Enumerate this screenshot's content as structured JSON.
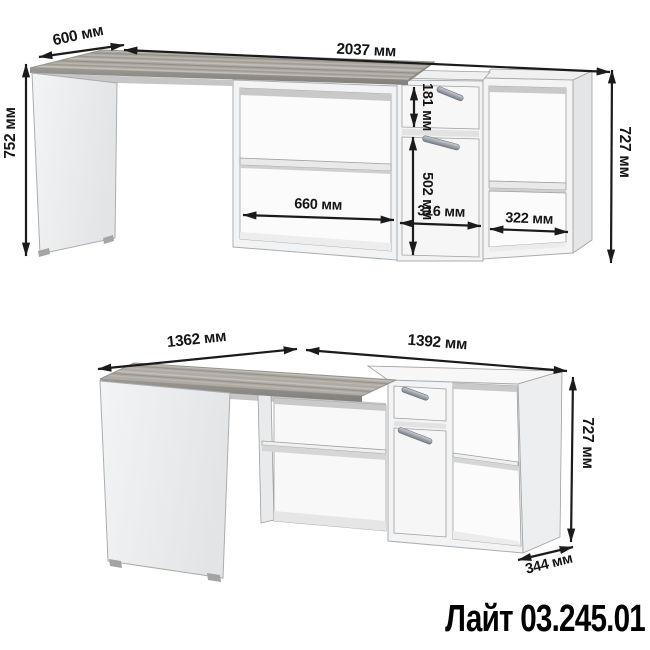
{
  "product": {
    "name": "Лайт 03.245.01"
  },
  "front_view": {
    "depth": "600 мм",
    "total_width": "2037 мм",
    "desk_height": "752 мм",
    "cabinet_height": "727 мм",
    "drawer_height": "181 мм",
    "door_height": "502 мм",
    "desk_niche_width": "660 мм",
    "drawer_section_width": "316 мм",
    "shelf_section_width": "322 мм"
  },
  "perspective_view": {
    "desk_length": "1362 мм",
    "cabinet_length": "1392 мм",
    "cabinet_height": "727 мм",
    "cabinet_depth": "344 мм"
  },
  "colors": {
    "background": "#ffffff",
    "dimension_lines": "#1b1b1b",
    "furniture_body": "#f2f3f4",
    "desktop_wood": "#aba7a1",
    "edge_band": "#8d8a86",
    "title_text": "#000000"
  }
}
